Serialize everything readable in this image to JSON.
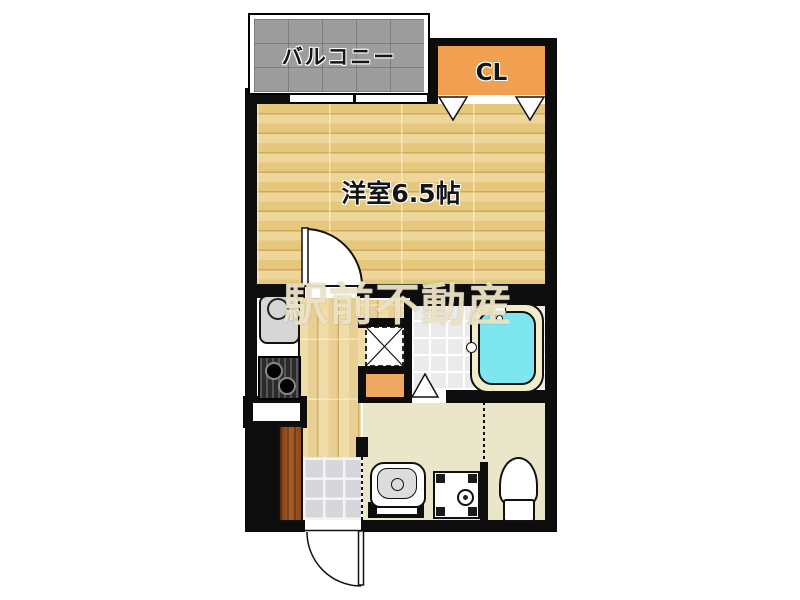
{
  "floorplan": {
    "watermark_text": "駅前不動産",
    "rooms": {
      "balcony_label": "バルコニー",
      "closet_label": "CL",
      "main_room_label": "洋室6.5帖"
    },
    "fixtures": [
      "kitchen-sink",
      "gas-stove",
      "refrigerator-space",
      "bathtub",
      "wash-basin",
      "washing-machine-space",
      "toilet",
      "shoe-cabinet",
      "entrance-door",
      "room-door",
      "closet-folding-door",
      "bathroom-folding-door",
      "balcony-window"
    ],
    "colors": {
      "wall": "#0d0d0d",
      "wood": "#e8cd85",
      "hall": "#ecd69e",
      "balcony": "#9d9d9d",
      "closet": "#f0a050",
      "accent": "#f0a860",
      "tub": "#7de6ef",
      "tub-rim": "#f2eccb",
      "cream": "#e9e6ca",
      "tile": "#ebebeb",
      "entrance": "#d7d7db",
      "cabinet": "#8a4a1a",
      "wm": "rgba(242,233,203,0.9)"
    }
  }
}
